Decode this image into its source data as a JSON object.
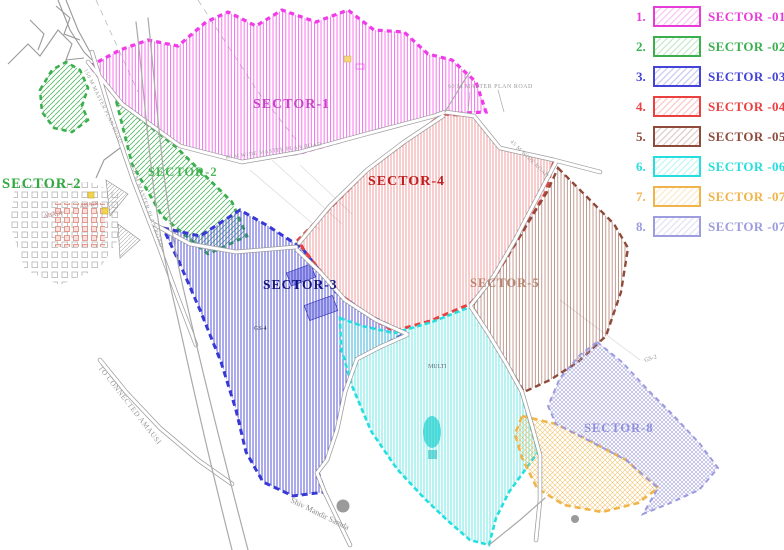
{
  "legend": {
    "items": [
      {
        "num": "1.",
        "label": "SECTOR -01",
        "color": "#E83CD8"
      },
      {
        "num": "2.",
        "label": "SECTOR -02",
        "color": "#3BAF4E"
      },
      {
        "num": "3.",
        "label": "SECTOR -03",
        "color": "#4343D8"
      },
      {
        "num": "4.",
        "label": "SECTOR -04",
        "color": "#EA4040"
      },
      {
        "num": "5.",
        "label": "SECTOR -05",
        "color": "#8E4B3B"
      },
      {
        "num": "6.",
        "label": "SECTOR -06",
        "color": "#27DEDE"
      },
      {
        "num": "7.",
        "label": "SECTOR -07",
        "color": "#F0B44A"
      },
      {
        "num": "8.",
        "label": "SECTOR -07",
        "color": "#9C9CDE"
      }
    ]
  },
  "map": {
    "sector_labels": {
      "s1": "SECTOR-1",
      "s2_left": "SECTOR-2",
      "s2_mid": "SECTOR-2",
      "s3": "SECTOR-3",
      "s4": "SECTOR-4",
      "s5": "SECTOR-5",
      "s8": "SECTOR-8"
    },
    "road_labels": {
      "master150": "150 M MASTER PLAN ROAD",
      "master60_along": "60 M WIDE MASTER PLAN ROAD",
      "master60_callout": "60 M MASTER PLAN ROAD",
      "wide45": "45 M WIDE ROAD",
      "amausi": "TO CONNECTED AMAUSI"
    },
    "poi_labels": {
      "temple": "Shiv Mandir Samda",
      "abadi": "ABADI",
      "gs4": "GS-4",
      "gs2": "GS-2",
      "multi": "MULTI"
    }
  },
  "colors": {
    "sector1": "#F03CE8",
    "sector2": "#3BAF4E",
    "sector3": "#3838D4",
    "sector4": "#E84040",
    "sector5": "#8E4B3B",
    "sector6": "#27DEDE",
    "sector7": "#F0B44A",
    "sector8": "#9C9CDE",
    "label-s1": "#C944C9",
    "label-s2": "#2FAA3F",
    "label-s3": "#14147E",
    "label-s4": "#C11F1F",
    "label-s5": "#B07A63",
    "label-s8": "#9191DC",
    "road-label": "#9A9A9A"
  }
}
